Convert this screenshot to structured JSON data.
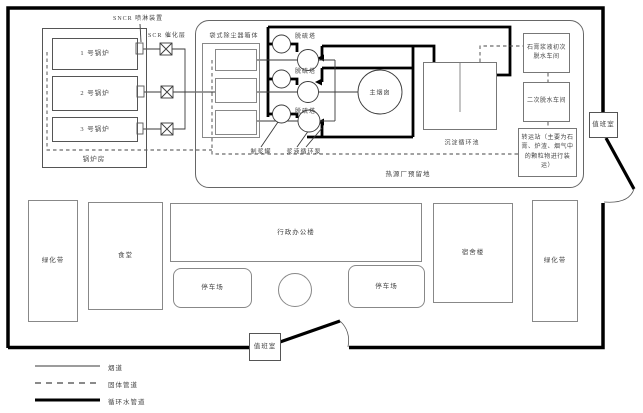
{
  "title": "厂区平面布置图",
  "boiler_area": {
    "house_label": "锅炉房",
    "boilers": [
      {
        "label": "1 号锅炉"
      },
      {
        "label": "2 号锅炉"
      },
      {
        "label": "3 号锅炉"
      }
    ],
    "sncr_label": "SNCR 喷淋装置",
    "scr_label": "SCR 催化层"
  },
  "process_area": {
    "reserved_label": "热源厂预留地",
    "bag_filter_label": "袋式除尘器箱体",
    "tower_labels": [
      "脱硫塔",
      "脱硫塔",
      "脱硫塔"
    ],
    "chimney_label": "主烟囱",
    "slurry_tank_label": "制浆罐",
    "slurry_pump_label": "浆液循环泵",
    "pool_label": "沉淀循环池",
    "gypsum_label": "石膏浆液初次脱水车间",
    "secondary_label": "二次脱水车间",
    "transfer_label": "转运站（主要为石膏、炉渣、烟气中的颗粒物进行装运）"
  },
  "campus": {
    "green_left_label": "绿化带",
    "canteen_label": "食堂",
    "office_label": "行政办公楼",
    "parking_left_label": "停车场",
    "parking_right_label": "停车场",
    "dorm_label": "宿舍楼",
    "green_right_label": "绿化带"
  },
  "gates": {
    "duty_right_label": "值班室",
    "duty_bottom_label": "值班室"
  },
  "legend": [
    {
      "label": "烟道",
      "style": "thin-solid"
    },
    {
      "label": "固体管道",
      "style": "dashed"
    },
    {
      "label": "循环水管道",
      "style": "thick-solid"
    }
  ],
  "colors": {
    "line_thin": "#3a3a3a",
    "line_thick": "#000000",
    "box_border": "#777777",
    "background": "#ffffff"
  }
}
